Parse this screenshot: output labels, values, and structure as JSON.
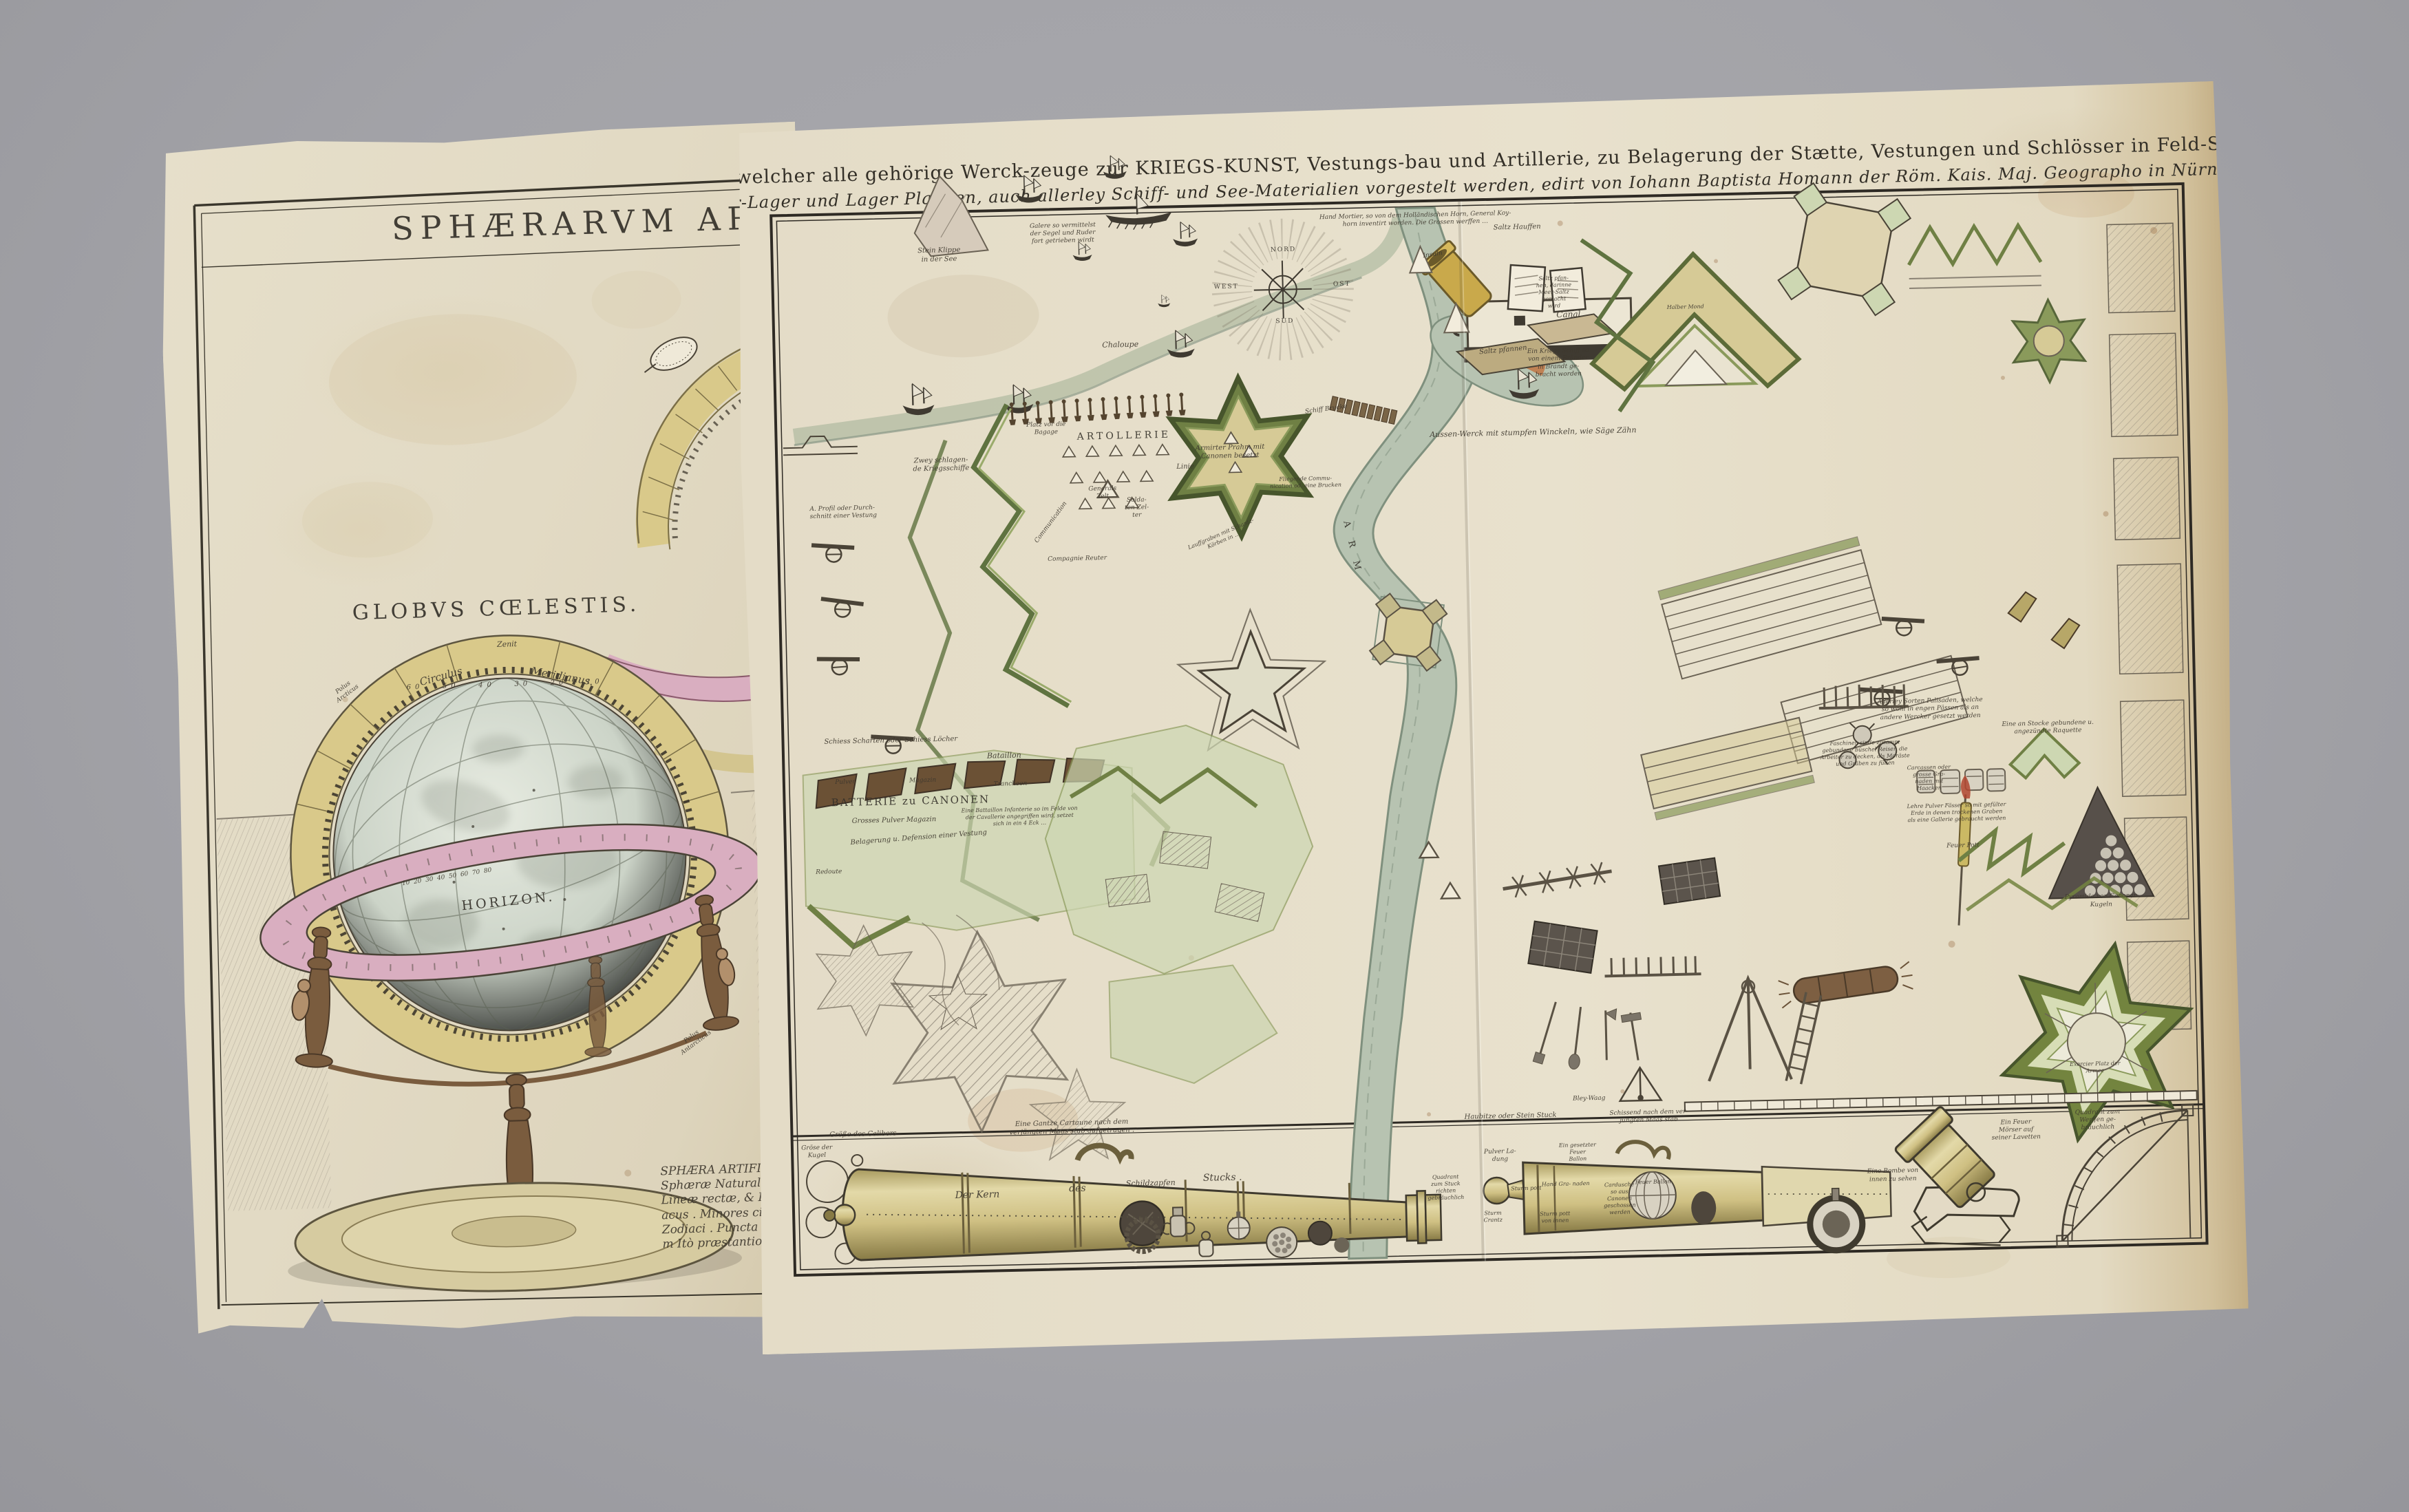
{
  "colors": {
    "background_gray": "#a3a3a8",
    "paper_right": "#e6dfca",
    "paper_left": "#e2dac4",
    "rampart_green": "#6f8044",
    "field_green": "#ccd6b2",
    "water_green": "#b7c3b1",
    "ring_yellow": "#d9c98a",
    "horizon_pink": "#d9aec0",
    "cannon_brass": "#cfc083",
    "ink": "#4a4337"
  },
  "left_sheet": {
    "title_fragment": "SPHÆRARVM ARTIF",
    "labels": [
      {
        "t": "SPHÆRARVM ARTIF",
        "x": 71,
        "y": 8,
        "fs": 46,
        "ls": 10,
        "roman": true
      },
      {
        "t": "GLOBVS CŒLESTIS.",
        "x": 51,
        "y": 40,
        "fs": 30,
        "ls": 6,
        "roman": true
      },
      {
        "t": "Zenit",
        "x": 52.5,
        "y": 43,
        "fs": 11
      },
      {
        "t": "Circulus",
        "x": 42,
        "y": 45.5,
        "fs": 15,
        "rot": -14
      },
      {
        "t": "Meridianus.",
        "x": 61,
        "y": 45.8,
        "fs": 15,
        "rot": 12
      },
      {
        "t": "60   50   40   30   20   10",
        "x": 52,
        "y": 46.4,
        "fs": 10,
        "ls": 6
      },
      {
        "t": "Polus\nArcticus",
        "x": 27,
        "y": 46.5,
        "fs": 9,
        "rot": -35
      },
      {
        "t": "HORIZON.",
        "x": 51.5,
        "y": 64.5,
        "fs": 19,
        "ls": 4,
        "roman": true,
        "rot": -4
      },
      {
        "t": "10  20  30  40  50  60  70  80",
        "x": 42,
        "y": 62.3,
        "fs": 9,
        "rot": -7
      },
      {
        "t": "Polus\nAntarcticus",
        "x": 80,
        "y": 76.5,
        "fs": 9,
        "rot": -35
      },
      {
        "t": "SPHÆRA ARTIFI\nSphæræ Naturali\nLineæ rectæ, & Pu\nacus . Minores circu\nZodiaci . Puncta de\nm Itò præstantior",
        "x": 83.5,
        "y": 90.5,
        "fs": 17,
        "align": "left"
      }
    ]
  },
  "right_sheet": {
    "title_line1": "TAFEL in welcher alle gehörige Werck-zeuge zur KRIEGS-KUNST, Vestungs-bau und Artillerie, zu Belagerung der Stætte, Vestungen und Schlösser in Feld-Schlachten",
    "title_line2": "Heer-Lager und Lager Plætzen, auch allerley Schiff- und See-Materialien vorgestelt werden, edirt von Iohann Baptista Homann der Röm. Kais. Maj. Geographo in Nürnberg",
    "labels": [
      {
        "t": "Stein Klippe\nin der See",
        "x": 11.7,
        "y": 4.0,
        "fs": 10
      },
      {
        "t": "Galere so vermittelst\nder Segel und Ruder\nfort getrieben wirdt",
        "x": 20.5,
        "y": 2.2,
        "fs": 9
      },
      {
        "t": "Hand Mortier, so von dem Holländischen Horn, General Koy-\nhorn inventirt worden. Die Grossen werffen …",
        "x": 45.5,
        "y": 1.6,
        "fs": 9
      },
      {
        "t": "Chaloupe",
        "x": 24.4,
        "y": 12.8,
        "fs": 11
      },
      {
        "t": "Zwey schlagen-\nde Kriegsschiffe",
        "x": 11.5,
        "y": 23.8,
        "fs": 10
      },
      {
        "t": "Armirter Prahm mit\nCanonen besetzt",
        "x": 32.0,
        "y": 23.2,
        "fs": 10
      },
      {
        "t": "Ein Kriegs Schiff so\nvon einem Bränder\nin Brandt ge-\nbracht worden",
        "x": 55.4,
        "y": 15.5,
        "fs": 9
      },
      {
        "t": "Insuln",
        "x": 46.7,
        "y": 5.0,
        "fs": 9,
        "rot": -8
      },
      {
        "t": "Saltz Hauffen",
        "x": 52.7,
        "y": 2.6,
        "fs": 10
      },
      {
        "t": "Saltz pfan-\nnen, darinne\nMeer-Saltz\ngemacht\nwird",
        "x": 55.2,
        "y": 8.8,
        "fs": 8
      },
      {
        "t": "Canal",
        "x": 56.2,
        "y": 10.9,
        "fs": 12
      },
      {
        "t": "Saltz pfannen",
        "x": 51.5,
        "y": 14.2,
        "fs": 10,
        "rot": -4
      },
      {
        "t": "Halber Mond",
        "x": 64.5,
        "y": 10.5,
        "fs": 8
      },
      {
        "t": "Aussen-Werck mit stumpfen Winckeln, wie Säge Zähn",
        "x": 53.5,
        "y": 22.0,
        "fs": 11
      },
      {
        "t": "ARTOLLERIE",
        "x": 24.5,
        "y": 21.5,
        "fs": 14,
        "ls": 4,
        "roman": true
      },
      {
        "t": "Platz vor die\nBagage",
        "x": 19.0,
        "y": 20.6,
        "fs": 9
      },
      {
        "t": "Linie",
        "x": 28.8,
        "y": 24.5,
        "fs": 10
      },
      {
        "t": "Generals\nZelt",
        "x": 22.9,
        "y": 26.8,
        "fs": 9
      },
      {
        "t": "Solda-\nten Zel-\nter",
        "x": 25.3,
        "y": 28.3,
        "fs": 9
      },
      {
        "t": "Communication",
        "x": 19.2,
        "y": 29.5,
        "fs": 9,
        "rot": -52
      },
      {
        "t": "Compagnie Reuter",
        "x": 21.0,
        "y": 33.0,
        "fs": 9
      },
      {
        "t": "Schiff Brucke",
        "x": 38.9,
        "y": 19.4,
        "fs": 9,
        "rot": -6
      },
      {
        "t": "Fliegende Commu-\nnication od. eine Brucken",
        "x": 37.3,
        "y": 26.2,
        "fs": 8
      },
      {
        "t": "Lauffgraben mit Schantz-\nKörben in …",
        "x": 31.3,
        "y": 31.2,
        "fs": 8,
        "rot": -22
      },
      {
        "t": "A R M",
        "x": 40.5,
        "y": 32.5,
        "fs": 13,
        "rot": 78,
        "ls": 8,
        "roman": true
      },
      {
        "t": "A. Profil oder Durch-\nschnitt einer Vestung",
        "x": 4.5,
        "y": 28.1,
        "fs": 9,
        "align": "left"
      },
      {
        "t": "NORD",
        "x": 36.1,
        "y": 4.2,
        "fs": 9,
        "ls": 2,
        "roman": true
      },
      {
        "t": "OST",
        "x": 40.2,
        "y": 7.6,
        "fs": 9,
        "ls": 2,
        "roman": true
      },
      {
        "t": "SUD",
        "x": 36.1,
        "y": 11.0,
        "fs": 9,
        "ls": 2,
        "roman": true
      },
      {
        "t": "WEST",
        "x": 32.0,
        "y": 7.6,
        "fs": 9,
        "ls": 2,
        "roman": true
      },
      {
        "t": "Bataillon",
        "x": 15.5,
        "y": 51.4,
        "fs": 11
      },
      {
        "t": "Schiess Scharten oder Schiess Löcher",
        "x": 7.5,
        "y": 49.8,
        "fs": 10
      },
      {
        "t": "Pulver",
        "x": 4.2,
        "y": 53.6,
        "fs": 9
      },
      {
        "t": "Magazin",
        "x": 9.7,
        "y": 53.6,
        "fs": 9
      },
      {
        "t": "BATTERIE zu CANONEN",
        "x": 8.8,
        "y": 55.5,
        "fs": 15,
        "ls": 2,
        "roman": true
      },
      {
        "t": "Grosses Pulver Magazin",
        "x": 7.6,
        "y": 57.3,
        "fs": 10
      },
      {
        "t": "Belagerung u. Defension einer Vestung",
        "x": 9.3,
        "y": 59.0,
        "fs": 10,
        "rot": -3
      },
      {
        "t": "Redoute",
        "x": 2.9,
        "y": 62.1,
        "fs": 9
      },
      {
        "t": "Trancheen",
        "x": 15.9,
        "y": 54.1,
        "fs": 9
      },
      {
        "t": "Eine Battaillon Infanterie so im Felde von\nder Cavallerie angegriffen wird, setzet\nsich in ein 4 Eck …",
        "x": 16.5,
        "y": 57.2,
        "fs": 8
      },
      {
        "t": "Allerley Sorten Palisaden, welche\nso wohl in engen Pässen als an\nandere Wercker gesetzt werden",
        "x": 81.2,
        "y": 49.0,
        "fs": 9
      },
      {
        "t": "Faschinen sinde zusamm\ngebundene büschel Reiser, die\nArbeiter zu decken, als Moräste\nund Gräben zu füllen",
        "x": 76.5,
        "y": 53.0,
        "fs": 8
      },
      {
        "t": "Carcassen oder\ngrosse Gra-\nnaden mit\nHaacken",
        "x": 81.0,
        "y": 55.5,
        "fs": 8
      },
      {
        "t": "Eine an Stocke gebundene u.\nangezündte Raquette",
        "x": 89.5,
        "y": 51.0,
        "fs": 9
      },
      {
        "t": "Pyramide von Canonen\nKugeln",
        "x": 93.0,
        "y": 67.5,
        "fs": 9
      },
      {
        "t": "Feuer Pott",
        "x": 83.3,
        "y": 62.0,
        "fs": 9
      },
      {
        "t": "Lehre Pulver Fässer so mit gefülter\nErde in denen trockenen Graben\nals eine Gallerie gebraucht werden",
        "x": 82.9,
        "y": 58.8,
        "fs": 8
      },
      {
        "t": "Gröse der\nKugel",
        "x": 1.6,
        "y": 88.5,
        "fs": 9
      },
      {
        "t": "Größe des Calibers",
        "x": 4.9,
        "y": 86.9,
        "fs": 10
      },
      {
        "t": "Eine Gantze Cartaune nach dem\nverjüngten Maas stab aufgetragen .",
        "x": 19.7,
        "y": 86.7,
        "fs": 10
      },
      {
        "t": "Der Kern",
        "x": 12.9,
        "y": 92.9,
        "fs": 14
      },
      {
        "t": "des",
        "x": 20.0,
        "y": 92.5,
        "fs": 14
      },
      {
        "t": "Schildzapfen",
        "x": 25.2,
        "y": 92.1,
        "fs": 11
      },
      {
        "t": "Stucks .",
        "x": 30.3,
        "y": 91.8,
        "fs": 14
      },
      {
        "t": "Haubitze oder Stein Stuck",
        "x": 50.8,
        "y": 86.6,
        "fs": 10
      },
      {
        "t": "Schissend nach dem ver-\njüngten Maas stab",
        "x": 60.6,
        "y": 86.9,
        "fs": 9
      },
      {
        "t": "Pulver La-\ndung",
        "x": 50.0,
        "y": 90.3,
        "fs": 9
      },
      {
        "t": "Ein gesetzter\nFeuer\nBallon",
        "x": 55.5,
        "y": 90.1,
        "fs": 8
      },
      {
        "t": "Quadrant\nzum Stuck\nrichten\ngebräuchlich",
        "x": 46.1,
        "y": 93.2,
        "fs": 8
      },
      {
        "t": "Sturm\nCrantz",
        "x": 49.4,
        "y": 96.0,
        "fs": 8
      },
      {
        "t": "Sturm pott",
        "x": 51.8,
        "y": 93.4,
        "fs": 8
      },
      {
        "t": "Hand Gra- naden",
        "x": 54.6,
        "y": 93.1,
        "fs": 8
      },
      {
        "t": "Sturm pott\nvon innen",
        "x": 53.8,
        "y": 96.2,
        "fs": 8
      },
      {
        "t": "Cardusche\nso aus\nCanonen\ngeschossen\nwerden",
        "x": 58.4,
        "y": 94.6,
        "fs": 8
      },
      {
        "t": "Feuer Ballon",
        "x": 60.8,
        "y": 93.1,
        "fs": 8
      },
      {
        "t": "Eine Bombe von\ninnen zu sehen",
        "x": 77.8,
        "y": 93.0,
        "fs": 9
      },
      {
        "t": "Ein Feuer\nMörser auf\nseiner Lavetten",
        "x": 86.6,
        "y": 89.0,
        "fs": 9
      },
      {
        "t": "Quadrant zum\nWerffen ge-\nbräuchlich",
        "x": 92.4,
        "y": 88.2,
        "fs": 9
      },
      {
        "t": "Bley-Waag",
        "x": 56.4,
        "y": 85.1,
        "fs": 9
      },
      {
        "t": "Exercier Platz der\nArmee",
        "x": 92.3,
        "y": 83.2,
        "fs": 8
      }
    ]
  }
}
